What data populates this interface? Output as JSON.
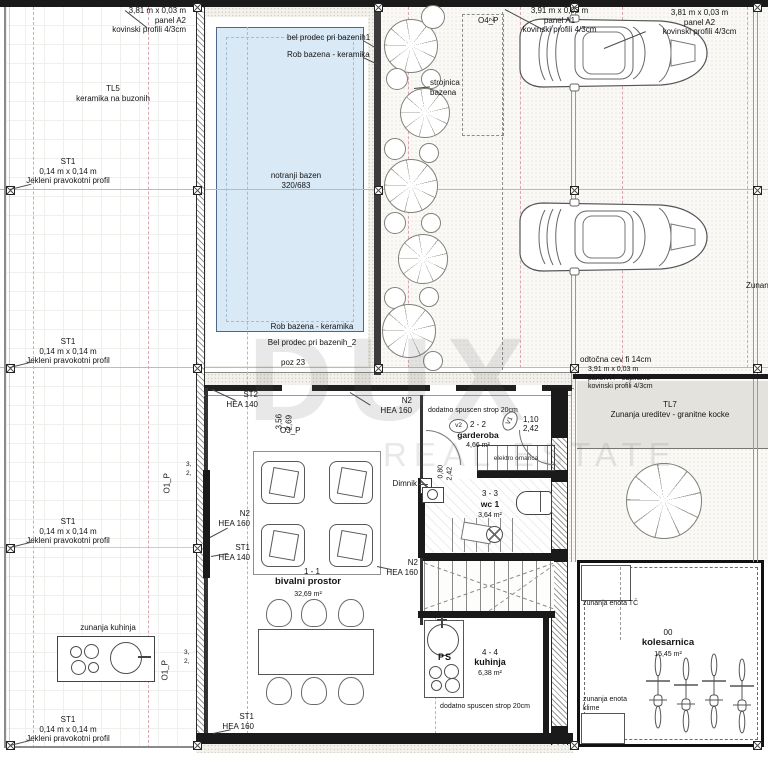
{
  "watermark": {
    "brand": "DUX",
    "tagline": "REAL ESTATE"
  },
  "panels": {
    "a2": {
      "dim": "3,81 m x 0,03 m",
      "name": "panel A2",
      "profile": "kovinski profili 4/3cm"
    },
    "a1": {
      "dim": "3,91 m x 0,03 m",
      "name": "panel A1",
      "profile": "kovinski profili 4/3cm"
    },
    "a4": {
      "dim": "3,91 m x 0,03 m",
      "name": "panel A4 - odpiralno",
      "profile": "kovinski profili 4/3cm"
    }
  },
  "columns": {
    "st1": {
      "code": "ST1",
      "dim": "0,14 m x 0,14 m",
      "profile": "Jekleni pravokotni profil"
    }
  },
  "surfaces": {
    "tl5": {
      "code": "TL5",
      "desc": "keramika na buzonih"
    },
    "tl7": {
      "code": "TL7",
      "desc": "Zunanja ureditev - granitne kocke"
    }
  },
  "pool": {
    "note_top1": "bel prodec pri bazenih1",
    "note_top2": "Rob bazena - keramika",
    "name": "notranji bazen",
    "size": "320/683",
    "note_bot1": "Rob bazena - keramika",
    "note_bot2": "Bel prodec pri bazenih_2",
    "poz": "poz 23",
    "strojnica1": "strojnica",
    "strojnica2": "bazena"
  },
  "beams": {
    "st2": {
      "code": "ST2",
      "profile": "HEA 140"
    },
    "n2": {
      "code": "N2",
      "profile": "HEA 160"
    },
    "st1_140": {
      "code": "ST1",
      "profile": "HEA 140"
    },
    "st1_160": {
      "code": "ST1",
      "profile": "HEA 160"
    }
  },
  "openings": {
    "o1p": "O1_P",
    "o3p": "O3_P",
    "o4p": "O4_P",
    "v1": "V1",
    "v2": "v2",
    "dim_110": "1,10",
    "dim_242": "2,42",
    "dim_080": "0,80",
    "dim_356": "3,56",
    "dim_269": "2,69",
    "dim_3": "3,",
    "dim_2": "2,"
  },
  "sections": {
    "s11": "1 - 1",
    "s22": "2 - 2",
    "s33": "3 - 3",
    "s44": "4 - 4"
  },
  "notes": {
    "dodatno_strop": "dodatno spuscen strop 20cm",
    "elektro": "elektro omarica",
    "dimnik": "Dimnik",
    "odtocna": "odtočna cev fi 14cm",
    "zunanja_edge": "Zunanja",
    "ps": "PS"
  },
  "rooms": {
    "garderoba": {
      "name": "garderoba",
      "area": "4,66 m²"
    },
    "wc": {
      "name": "wc 1",
      "area": "3,64 m²"
    },
    "bivalni": {
      "name": "bivalni prostor",
      "area": "32,69 m²"
    },
    "kuhinja": {
      "name": "kuhinja",
      "area": "6,38 m²"
    },
    "zunanja_kuhinja": "zunanja kuhinja",
    "kolesarnica": {
      "num": "00",
      "name": "kolesarnica",
      "area": "15,45 m²"
    },
    "enota_tc": "zunanja enota TČ",
    "enota_klime1": "zunanja enota",
    "enota_klime2": "klime"
  }
}
